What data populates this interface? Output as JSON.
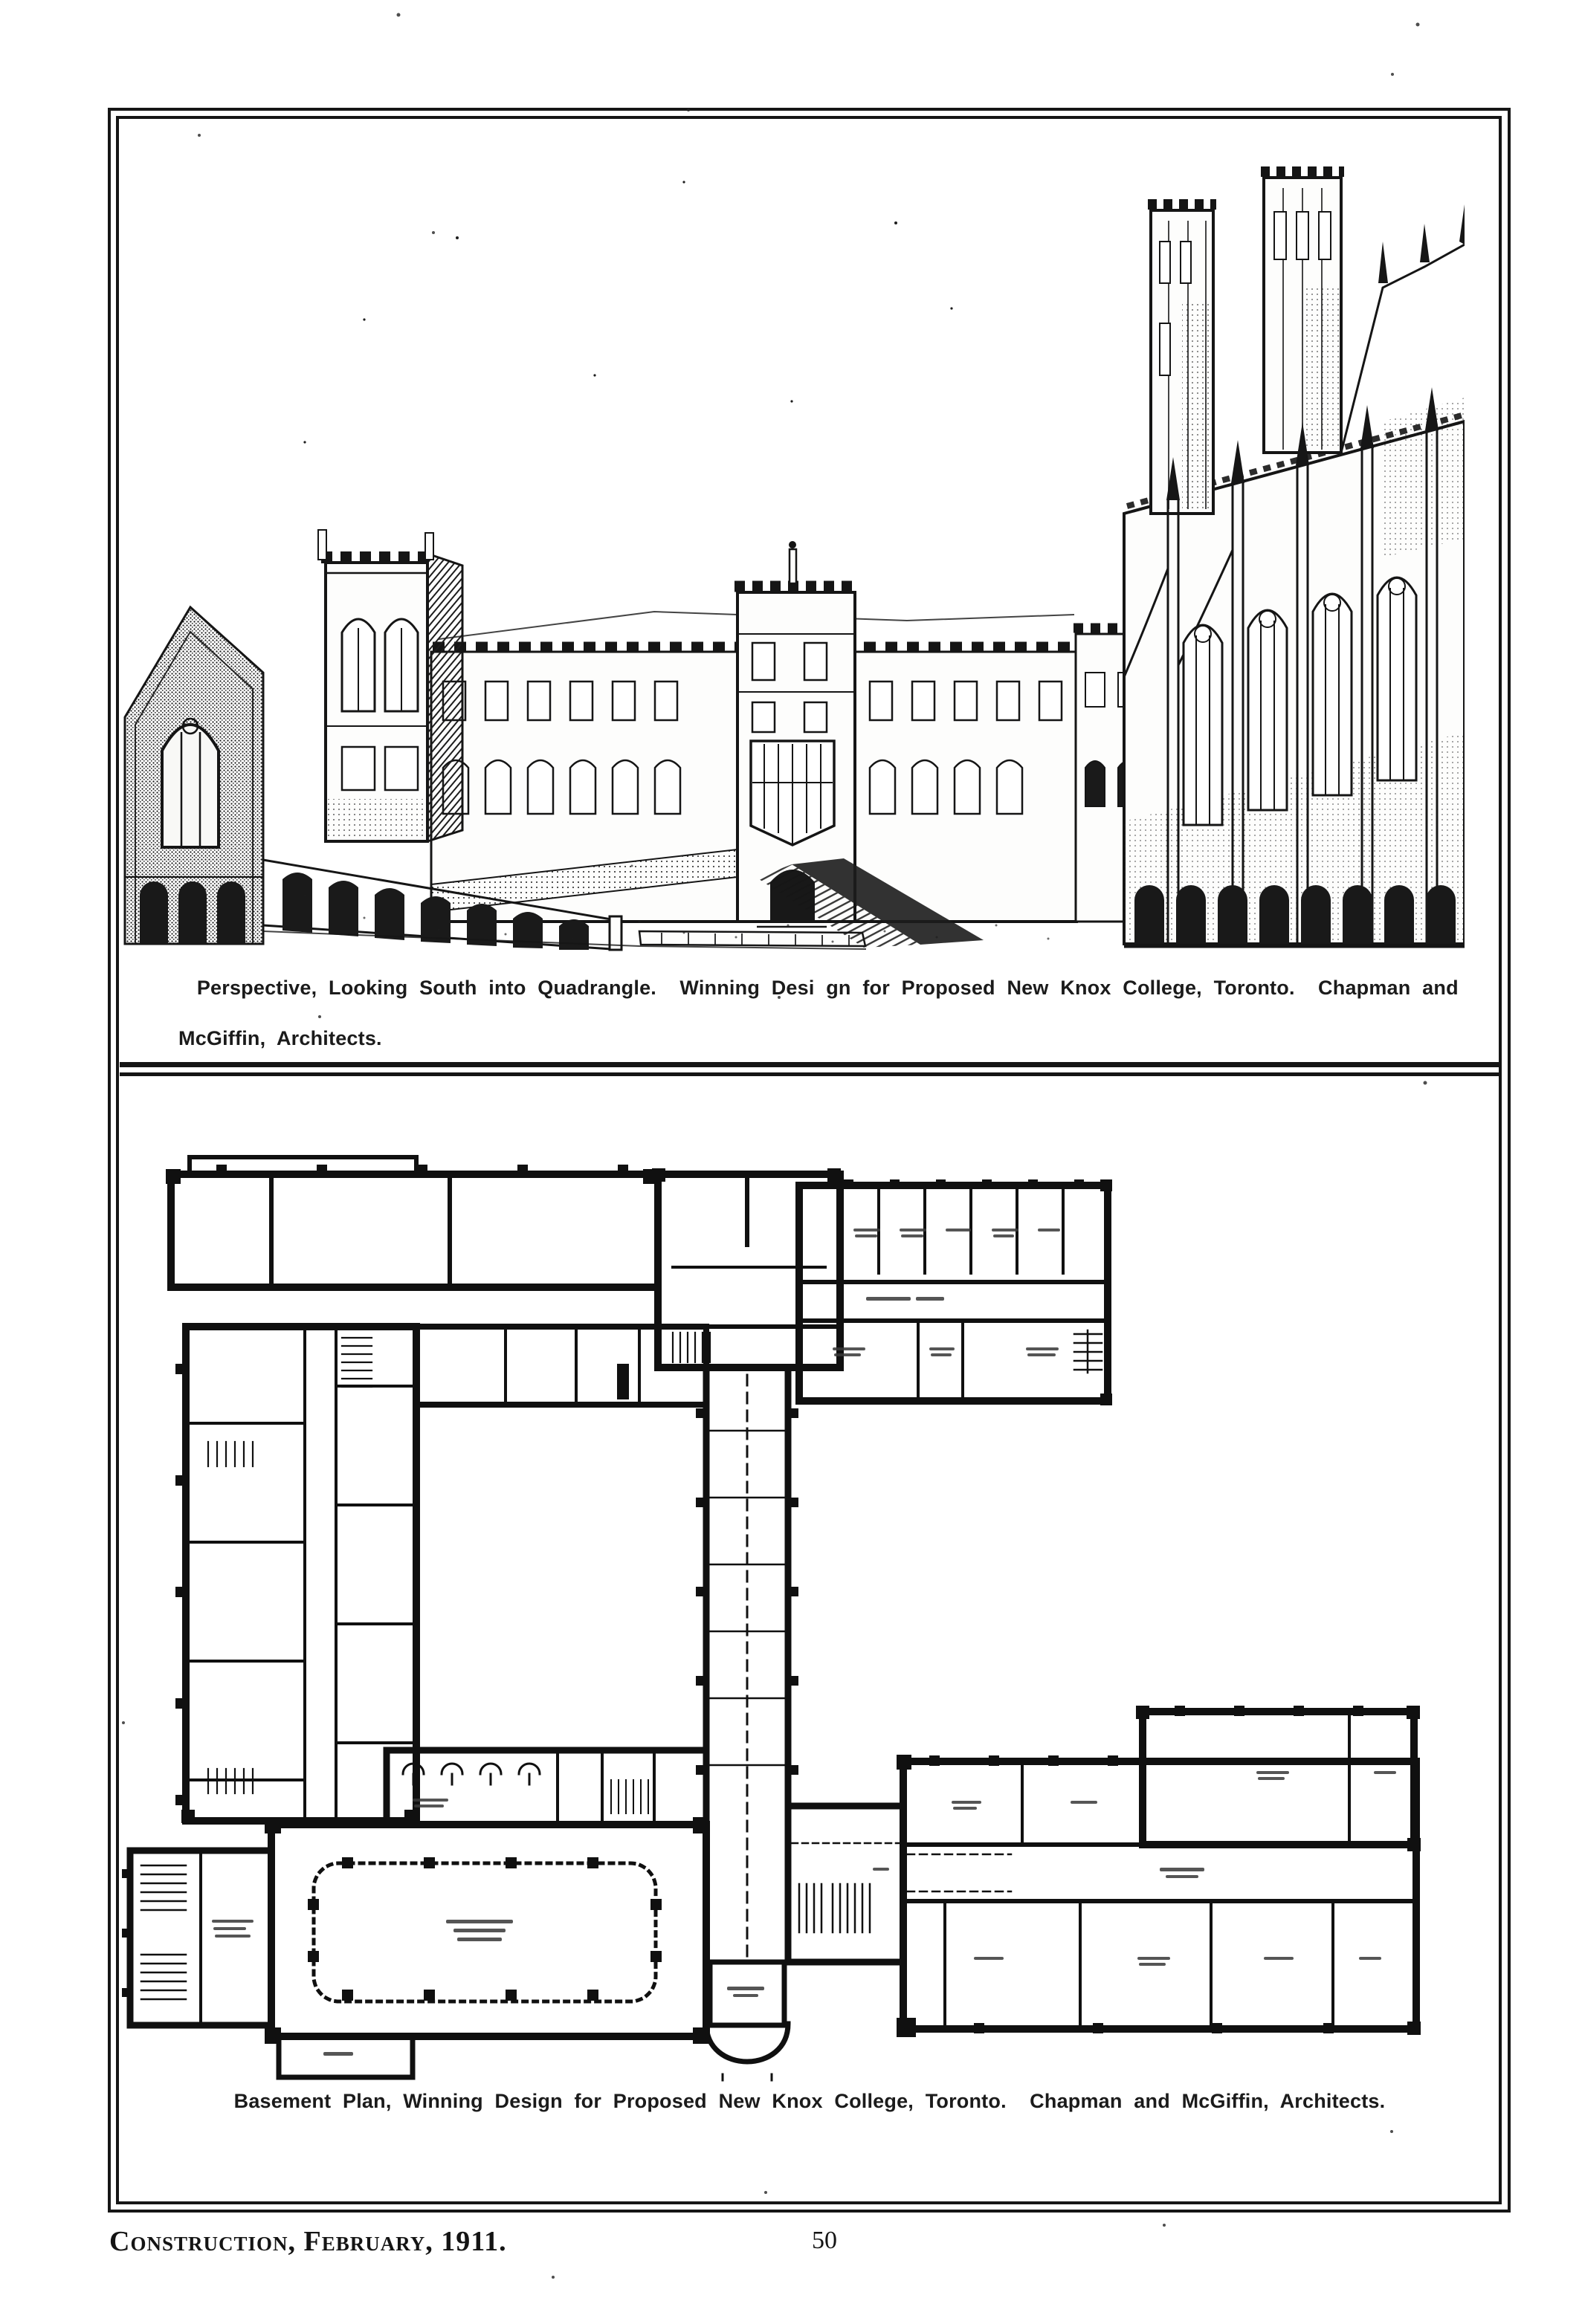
{
  "page": {
    "paper_color": "#ffffff",
    "ink_color": "#141414"
  },
  "figures": {
    "perspective": {
      "caption_line1": "Perspective, Looking South into Quadrangle.  Winning Desi gn for Proposed New Knox College, Toronto.  Chapman and",
      "caption_line2": "McGiffin, Architects."
    },
    "basement_plan": {
      "caption": "Basement Plan, Winning Design for Proposed New Knox College, Toronto.  Chapman and McGiffin, Architects."
    }
  },
  "footer": {
    "journal_line": "Construction, February, 1911.",
    "page_number": "50"
  }
}
